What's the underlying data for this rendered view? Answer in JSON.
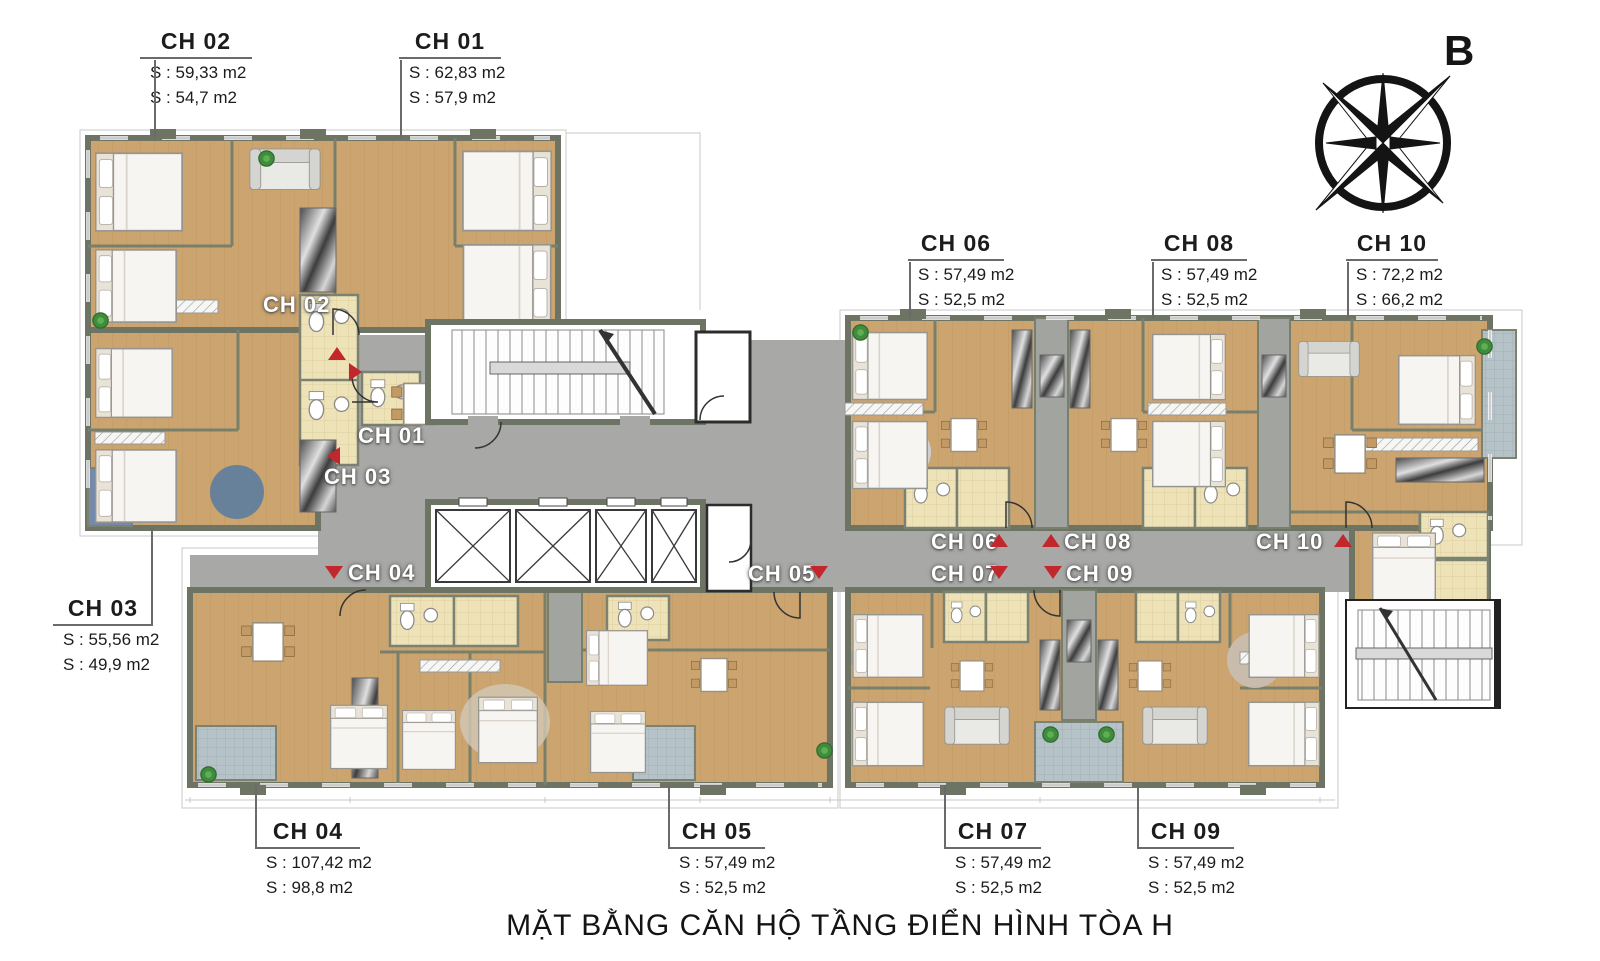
{
  "title": "MẶT BẰNG CĂN HỘ TẦNG ĐIỂN HÌNH TÒA H",
  "compass": {
    "north_label": "B"
  },
  "callouts": {
    "ch01": {
      "label": "CH 01",
      "areas": [
        "S : 62,83 m2",
        "S : 57,9 m2"
      ]
    },
    "ch02": {
      "label": "CH 02",
      "areas": [
        "S : 59,33 m2",
        "S : 54,7 m2"
      ]
    },
    "ch03": {
      "label": "CH 03",
      "areas": [
        "S : 55,56 m2",
        "S : 49,9 m2"
      ]
    },
    "ch04": {
      "label": "CH 04",
      "areas": [
        "S : 107,42 m2",
        "S : 98,8 m2"
      ]
    },
    "ch05": {
      "label": "CH 05",
      "areas": [
        "S : 57,49 m2",
        "S : 52,5 m2"
      ]
    },
    "ch06": {
      "label": "CH 06",
      "areas": [
        "S : 57,49 m2",
        "S : 52,5 m2"
      ]
    },
    "ch07": {
      "label": "CH 07",
      "areas": [
        "S : 57,49 m2",
        "S : 52,5 m2"
      ]
    },
    "ch08": {
      "label": "CH 08",
      "areas": [
        "S : 57,49 m2",
        "S : 52,5 m2"
      ]
    },
    "ch09": {
      "label": "CH 09",
      "areas": [
        "S : 57,49 m2",
        "S : 52,5 m2"
      ]
    },
    "ch10": {
      "label": "CH 10",
      "areas": [
        "S : 72,2 m2",
        "S : 66,2 m2"
      ]
    }
  },
  "markers": {
    "ch01": {
      "label": "CH 01",
      "arrow": "right"
    },
    "ch02": {
      "label": "CH 02",
      "arrow": "up"
    },
    "ch03": {
      "label": "CH 03",
      "arrow": "left"
    },
    "ch04": {
      "label": "CH 04",
      "arrow": "down"
    },
    "ch05": {
      "label": "CH 05",
      "arrow": "down"
    },
    "ch06": {
      "label": "CH 06",
      "arrow": "up"
    },
    "ch07": {
      "label": "CH 07",
      "arrow": "down"
    },
    "ch08": {
      "label": "CH 08",
      "arrow": "up"
    },
    "ch09": {
      "label": "CH 09",
      "arrow": "down"
    },
    "ch10": {
      "label": "CH 10",
      "arrow": "up"
    }
  },
  "colors": {
    "wall": "#6d7463",
    "corridor": "#a8a8a6",
    "wood_floor": "#cba46f",
    "bath_tile": "#eee2b8",
    "balcony_tile": "#b5c3c9",
    "arrow_red": "#c1272d"
  }
}
